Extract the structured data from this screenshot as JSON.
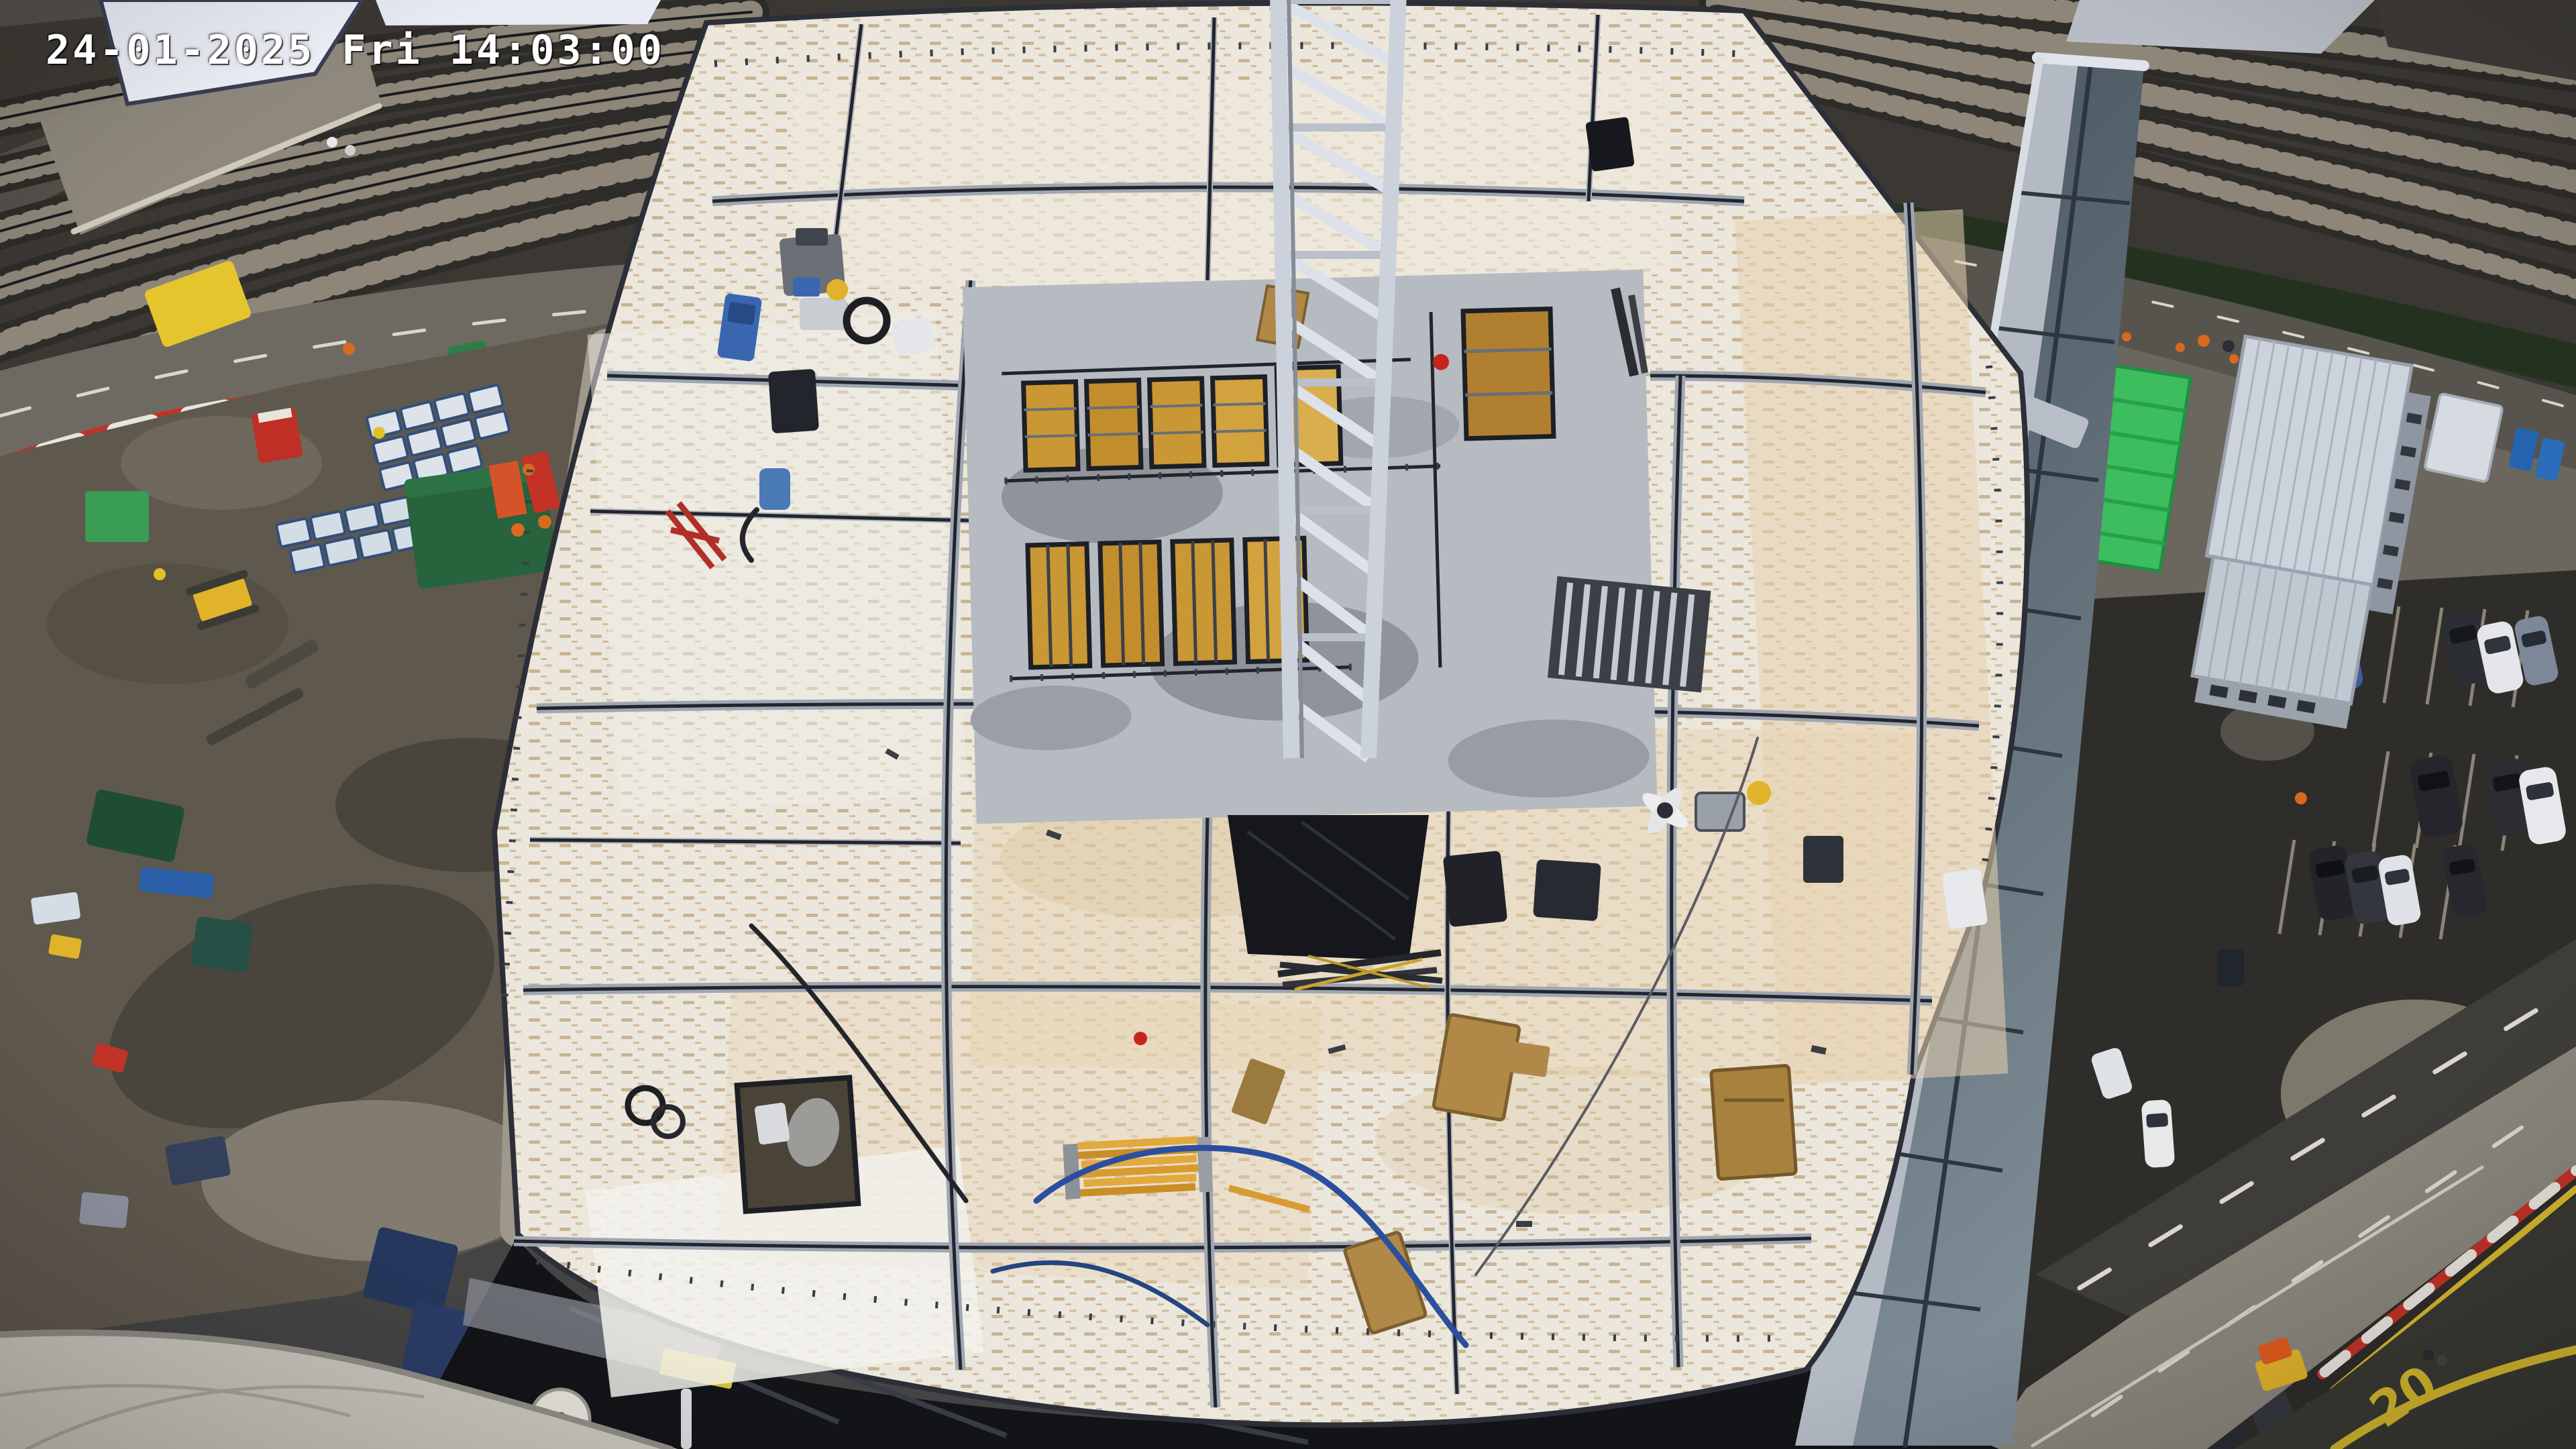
{
  "overlay": {
    "timestamp": "24-01-2025 Fri 14:03:00"
  },
  "road": {
    "speed_marking": "20"
  },
  "colors": {
    "ballast": "#3b3833",
    "sleeper": "#8d8679",
    "rail": "#1a1b1e",
    "deck": "#ebe7dc",
    "deck_tan": "#e7d3b2",
    "deck_white": "#f2f1ec",
    "steel": "#9ea6b2",
    "steel_dark": "#23242c",
    "crane": "#ccd2dc",
    "crane_hi": "#dde2ea",
    "core": "#b6bac1",
    "core_wet": "#8f949b",
    "formwork": "#c99733",
    "wood": "#b08948",
    "platform": "#8f897d",
    "canopy_white": "#eef0f8",
    "road": "#6e6a62",
    "lane": "#d9d6cc",
    "mud": "#5f584d",
    "mud_dark": "#49443c",
    "mud_light": "#827b6f",
    "barrier_red": "#c23227",
    "barrier_white": "#e8e5df",
    "stack_white": "#dde3e9",
    "stack_edge": "#2f4f7e",
    "green_container": "#27633c",
    "green_module": "#3cbd5e",
    "cabin_roof": "#ccd3dc",
    "glass_top": "#45525c",
    "glass_bottom": "#7e8c96",
    "mullion": "#2e3640",
    "asphalt": "#2f2d2a",
    "works": "#8a867c",
    "marking_yellow": "#d6b92f",
    "cable_blue": "#2b4f9e",
    "beam_yellow": "#e2a93c",
    "hedge": "#23321f",
    "underdeck": "#131418",
    "canopy_bl": "#c8c6bd",
    "cone": "#d86a1f"
  }
}
